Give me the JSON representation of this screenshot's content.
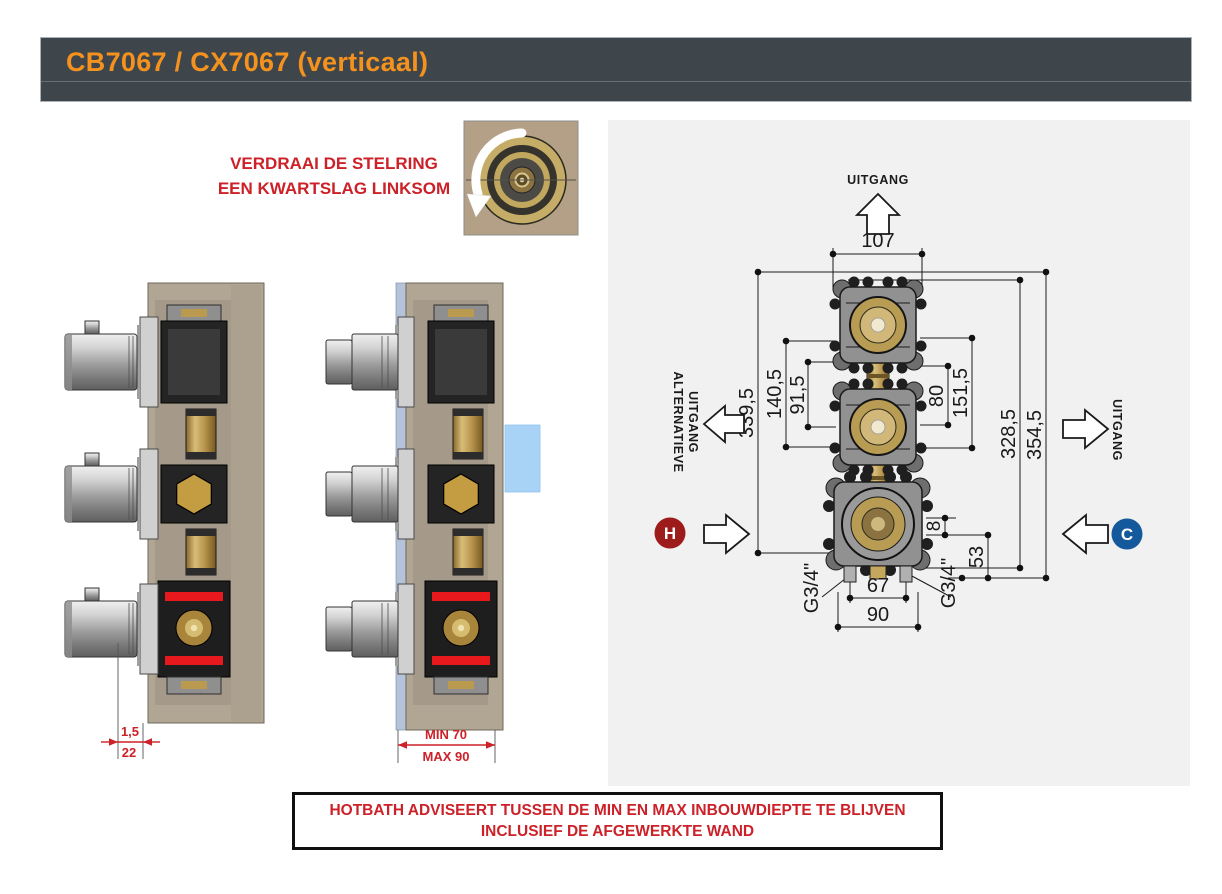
{
  "header": {
    "title": "CB7067 / CX7067 (verticaal)"
  },
  "instruction": {
    "line1": "VERDRAAI DE STELRING",
    "line2": "EEN KWARTSLAG LINKSOM"
  },
  "diagram": {
    "outlet_top_label": "UITGANG",
    "outlet_right_label": "UITGANG",
    "outlet_alt_line1": "ALTERNATIEVE",
    "outlet_alt_line2": "UITGANG",
    "hot_label": "H",
    "cold_label": "C",
    "dims": {
      "top_width": "107",
      "left_outer": "339,5",
      "left_mid": "140,5",
      "left_inner": "91,5",
      "right_inner": "80",
      "right_mid": "151,5",
      "right_outer1": "328,5",
      "right_outer2": "354,5",
      "offset_small": "8",
      "offset_bottom": "53",
      "bottom_inner": "67",
      "bottom_outer": "90",
      "thread_left": "G3/4\"",
      "thread_right": "G3/4\""
    }
  },
  "section_dims": {
    "plate_thickness": "1,5",
    "wall_thickness": "22",
    "min_depth": "MIN 70",
    "max_depth": "MAX 90"
  },
  "advisory": {
    "line1": "HOTBATH ADVISEERT TUSSEN DE MIN EN MAX INBOUWDIEPTE TE BLIJVEN",
    "line2": "INCLUSIEF DE AFGEWERKTE WAND"
  },
  "colors": {
    "accent_orange": "#F5921E",
    "warning_red": "#CC2128",
    "hot_red": "#9E1B1B",
    "cold_blue": "#15599D",
    "header_bg": "#3E464C",
    "panel_bg": "#F1F1F2",
    "wall_tan": "#B1A593",
    "brass": "#C8A95C",
    "highlight_blue": "#A9D3F6"
  }
}
